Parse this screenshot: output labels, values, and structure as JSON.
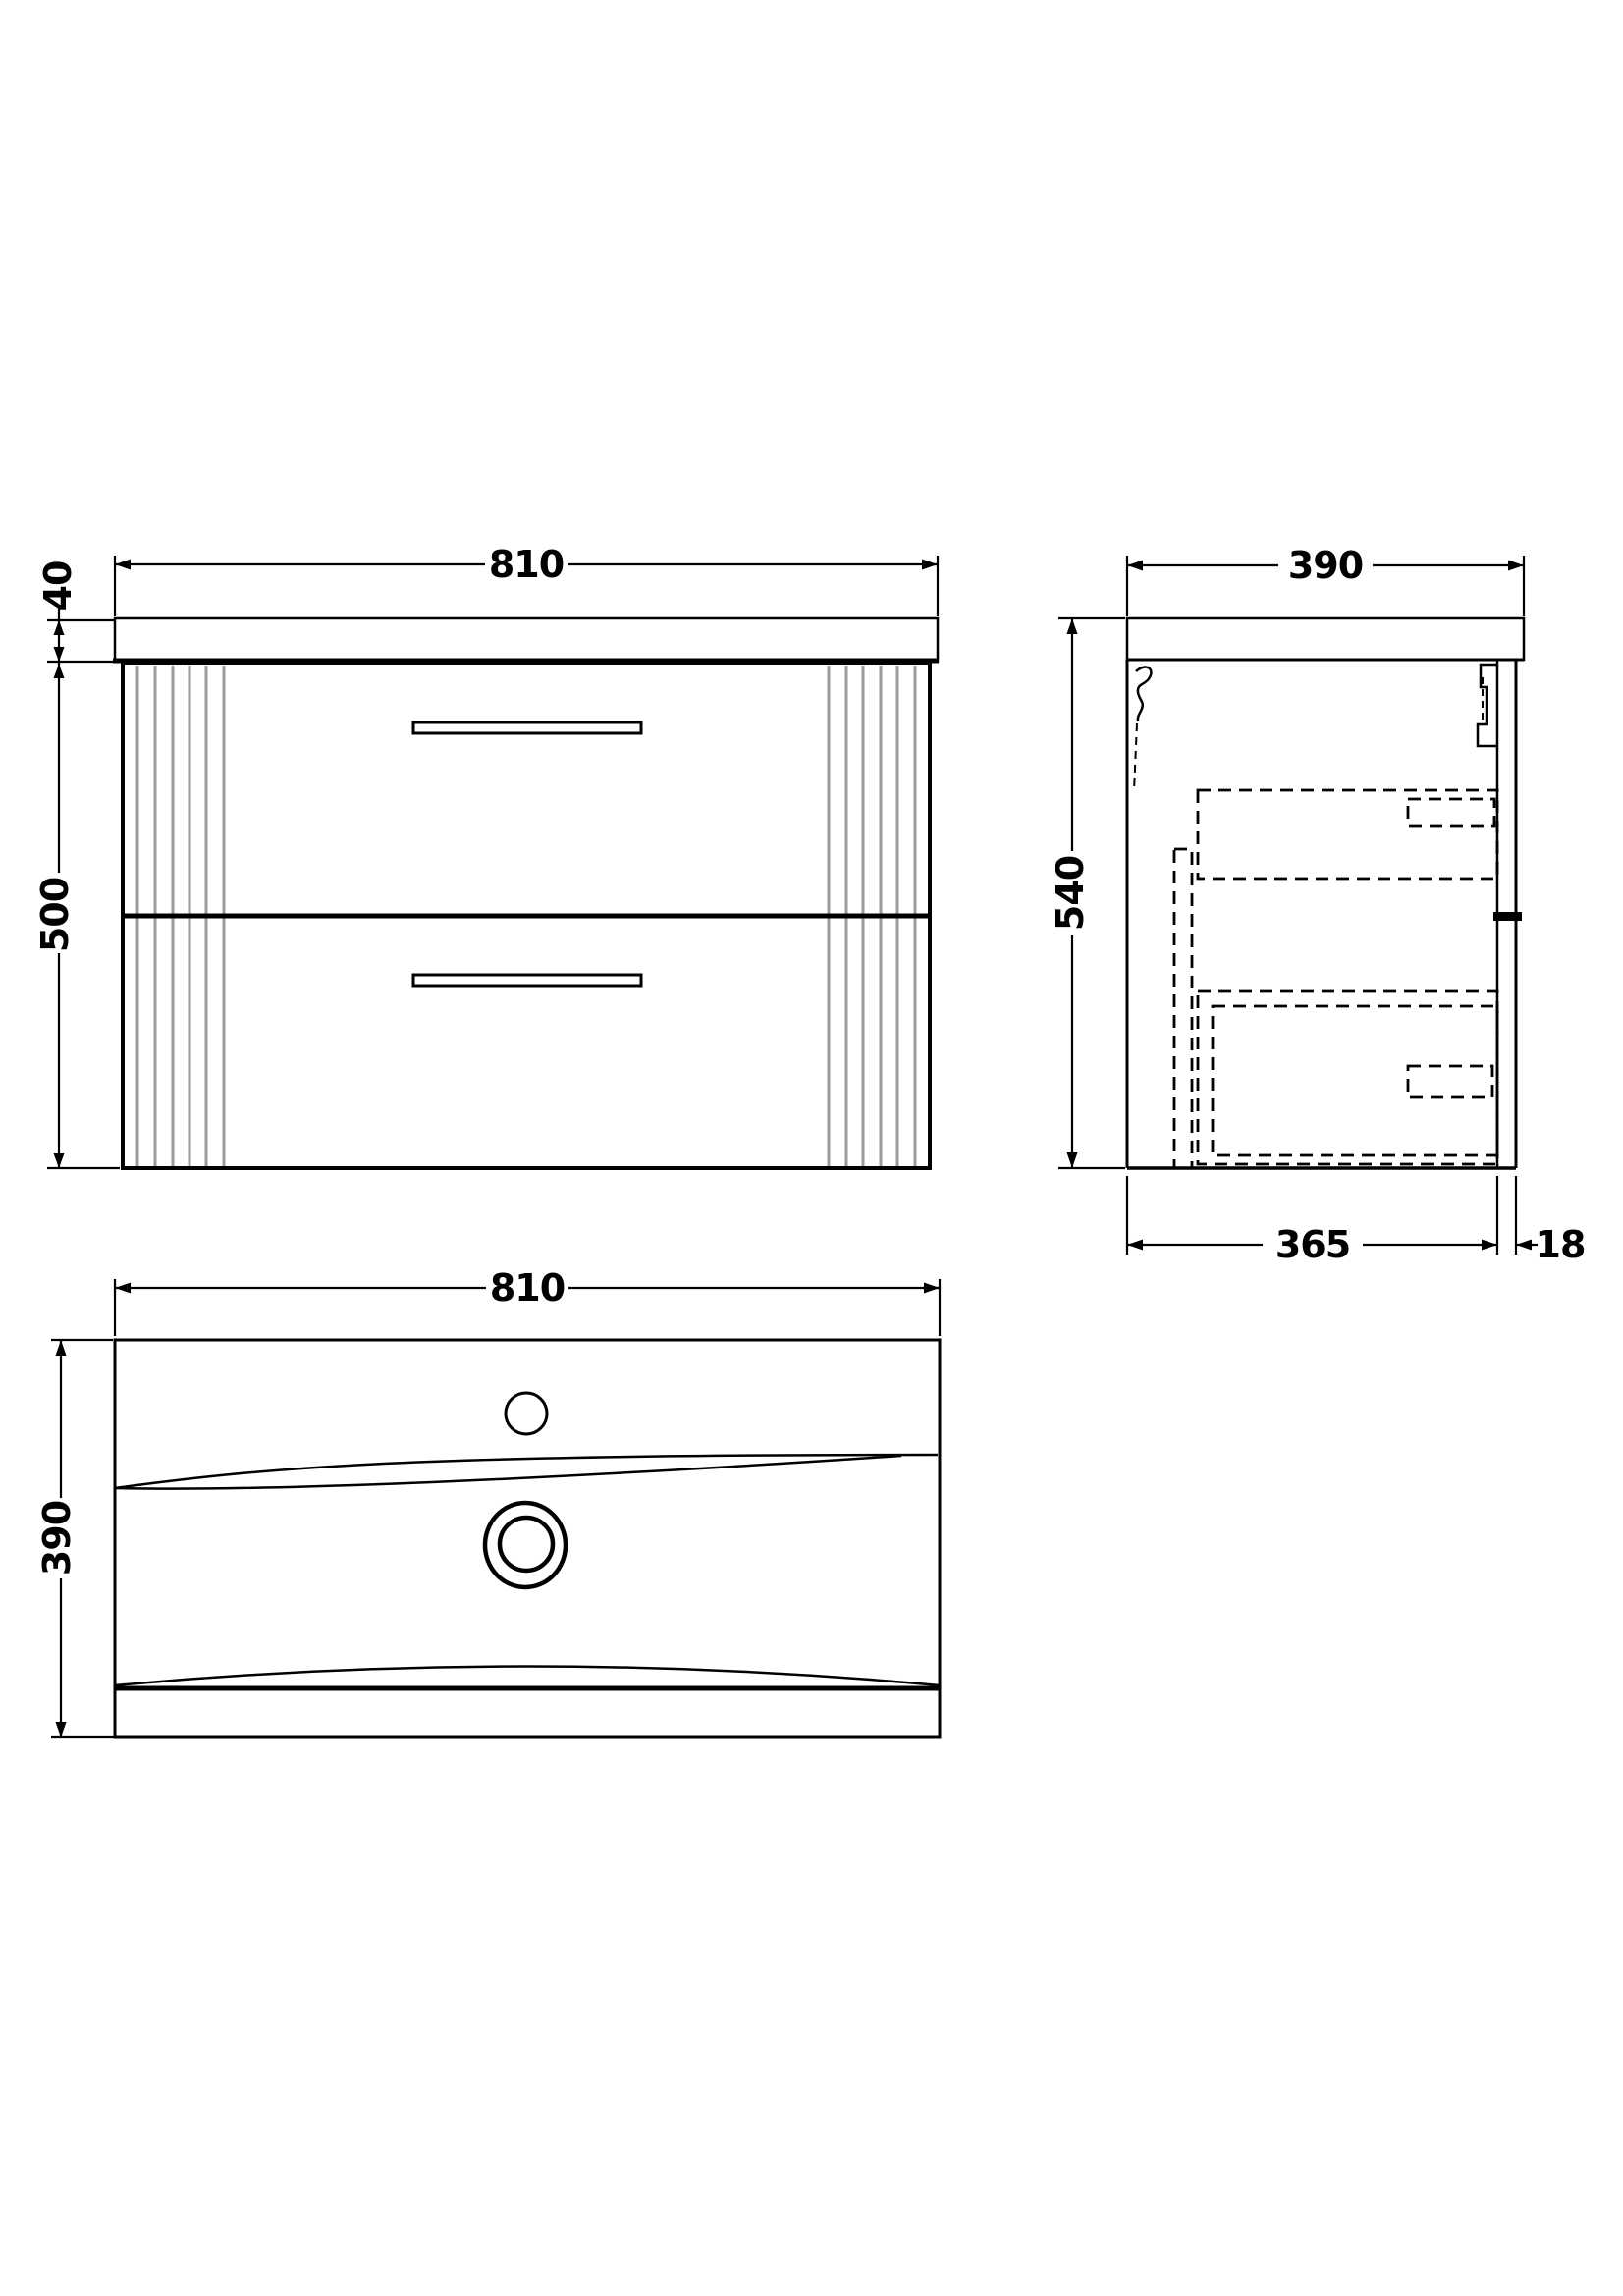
{
  "drawing": {
    "title": "wall-hung vanity unit technical drawing",
    "colors": {
      "background": "#ffffff",
      "line": "#000000",
      "flute": "#9b9b9b"
    },
    "dimensions": {
      "front": {
        "width": "810",
        "worktop": "40",
        "cabinet_height": "500"
      },
      "side": {
        "depth": "390",
        "height": "540",
        "cabinet_depth": "365",
        "front_panel": "18"
      },
      "plan": {
        "width": "810",
        "depth": "390"
      }
    }
  }
}
